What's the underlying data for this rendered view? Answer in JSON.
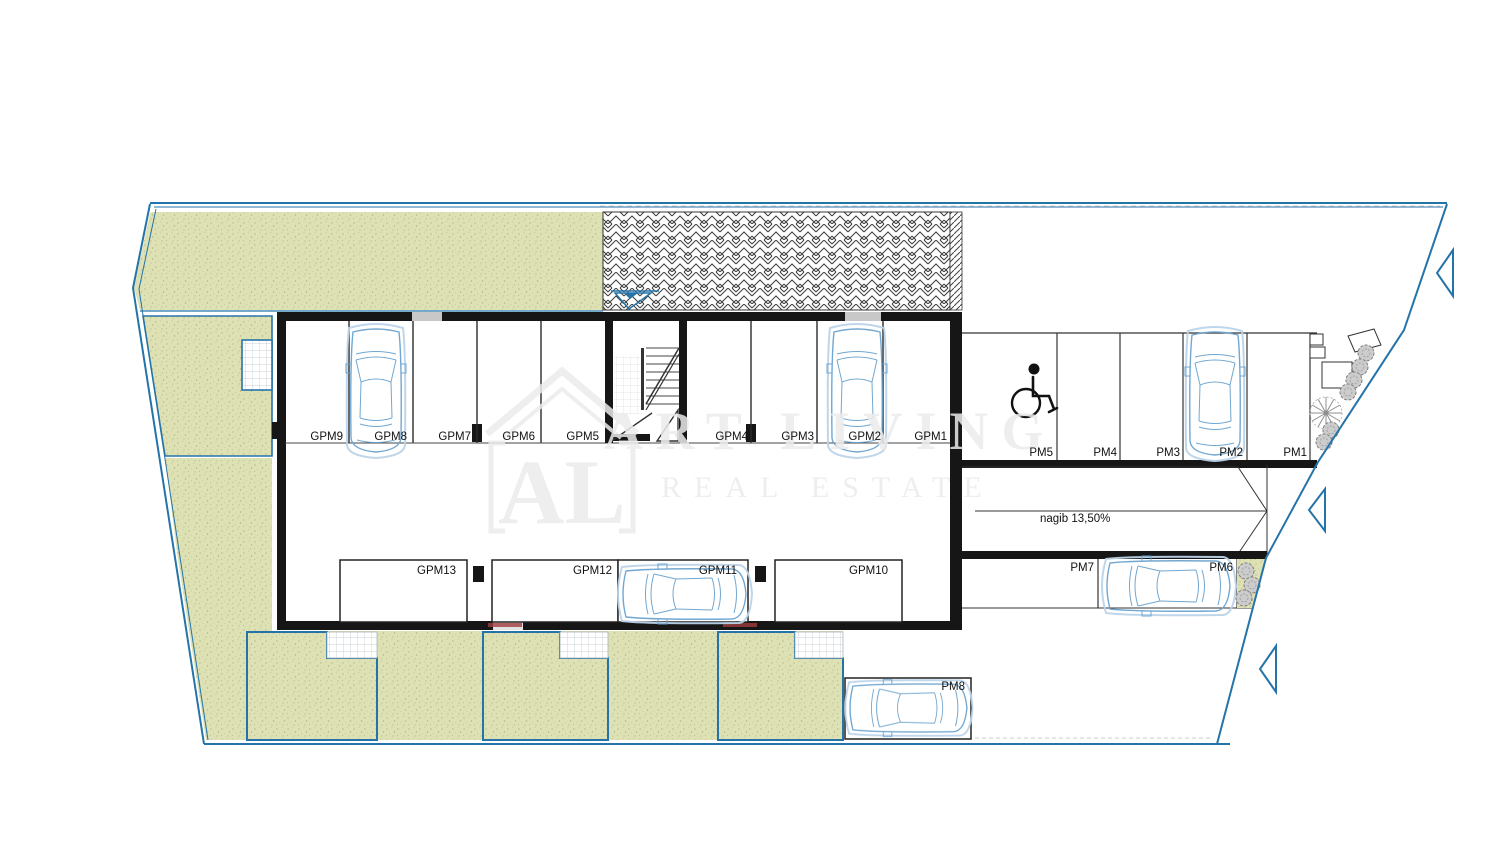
{
  "watermark": {
    "logo": "AL",
    "title": "ART LIVING",
    "subtitle": "REAL ESTATE"
  },
  "ramp": {
    "slope_label": "nagib 13,50%"
  },
  "garage": {
    "top_row": [
      {
        "label": "GPM9"
      },
      {
        "label": "GPM8"
      },
      {
        "label": "GPM7"
      },
      {
        "label": "GPM6"
      },
      {
        "label": "GPM5"
      },
      {
        "label": "GPM4"
      },
      {
        "label": "GPM3"
      },
      {
        "label": "GPM2"
      },
      {
        "label": "GPM1"
      }
    ],
    "bottom_row": [
      {
        "label": "GPM13"
      },
      {
        "label": "GPM12"
      },
      {
        "label": "GPM11"
      },
      {
        "label": "GPM10"
      }
    ]
  },
  "outdoor_parking": {
    "north_row": [
      {
        "label": "PM5"
      },
      {
        "label": "PM4"
      },
      {
        "label": "PM3"
      },
      {
        "label": "PM2"
      },
      {
        "label": "PM1"
      }
    ],
    "south_row": [
      {
        "label": "PM7"
      },
      {
        "label": "PM6"
      }
    ],
    "street_row": [
      {
        "label": "PM8"
      }
    ]
  },
  "icons": {
    "accessible_parking": "wheelchair-icon",
    "boundary_marker": "triangle-marker-icon",
    "entrance_marker": "survey-triangle-icon",
    "tree": "tree-icon",
    "car": "car-icon"
  },
  "colors": {
    "boundary": "#2574a9",
    "lawn": "#dde1b4",
    "wall": "#161616",
    "car": "#6aa3cf",
    "tree": "#8f8f8f",
    "label": "#111111",
    "door_accent": "#a03c3c"
  }
}
